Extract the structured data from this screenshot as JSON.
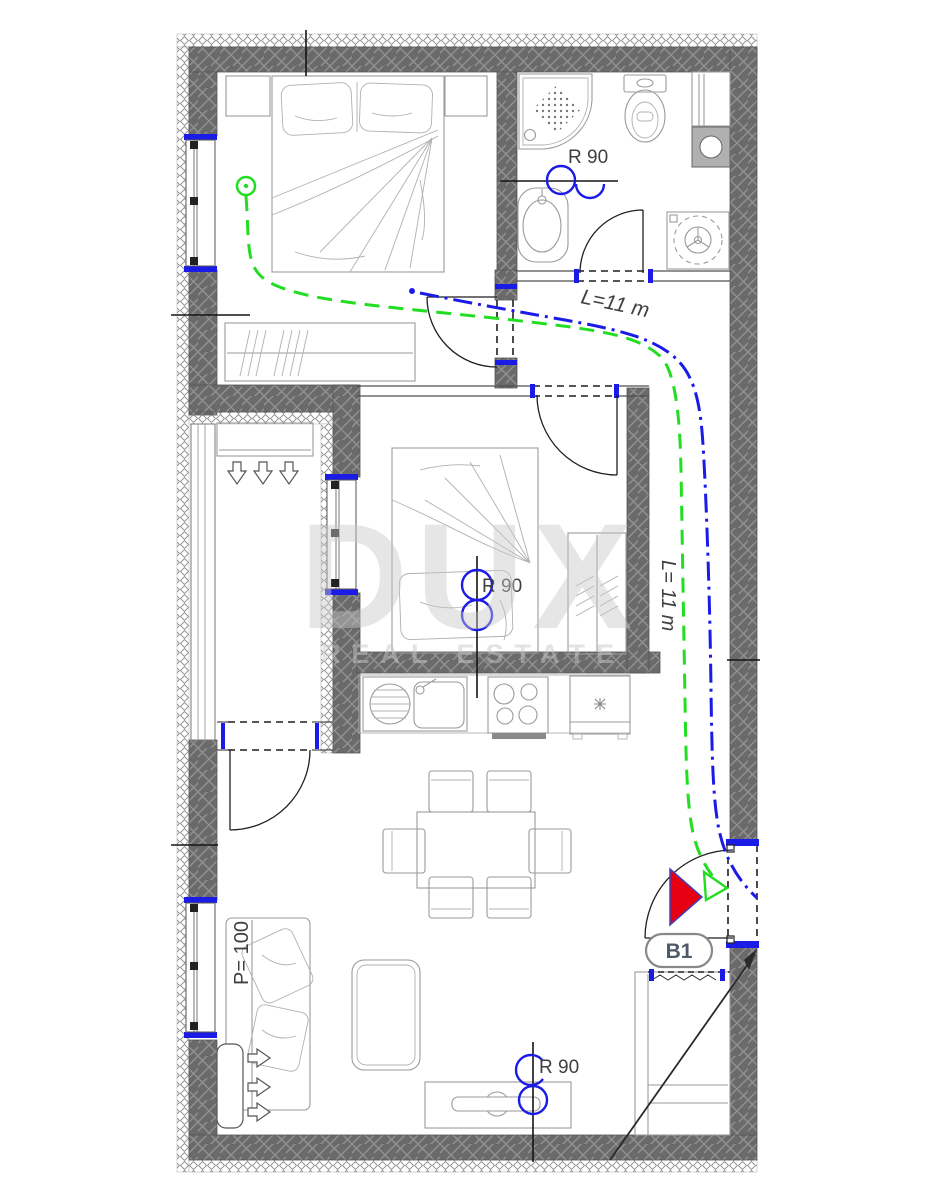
{
  "plan": {
    "title": "apartment-floor-plan",
    "labels": {
      "fire_rating_bathroom": "R 90",
      "fire_rating_bedroom": "R 90",
      "fire_rating_living": "R 90",
      "route_length_hall": "L=11 m",
      "route_length_corridor": "L= 11 m",
      "terrace_area": "P= 100",
      "exit_tag": "B1"
    },
    "watermark": {
      "line1": "DUX",
      "line2": "REAL ESTATE"
    },
    "colors": {
      "c-blue": "#1b1be8",
      "c-green": "#22dd22",
      "c-red": "#e60012",
      "c-furn": "#9a9a9a",
      "c-label": "#3f3f3f",
      "c-wm": "#c8c8c8",
      "wall_fill": "#6a6a6a",
      "wall_hatch": "#919191"
    },
    "icons": [
      "double-bed-icon",
      "single-bed-icon",
      "shower-icon",
      "toilet-icon",
      "sink-icon",
      "washing-machine-icon",
      "kitchen-sink-icon",
      "stove-icon",
      "fridge-icon",
      "dining-table-icon",
      "chair-icon",
      "sofa-icon",
      "coffee-table-icon",
      "tv-console-icon",
      "radiator-icon",
      "wardrobe-icon",
      "dresser-icon",
      "exit-triangle-icon",
      "escape-route-green",
      "escape-route-blue",
      "window-icon",
      "door-arc-icon"
    ]
  }
}
